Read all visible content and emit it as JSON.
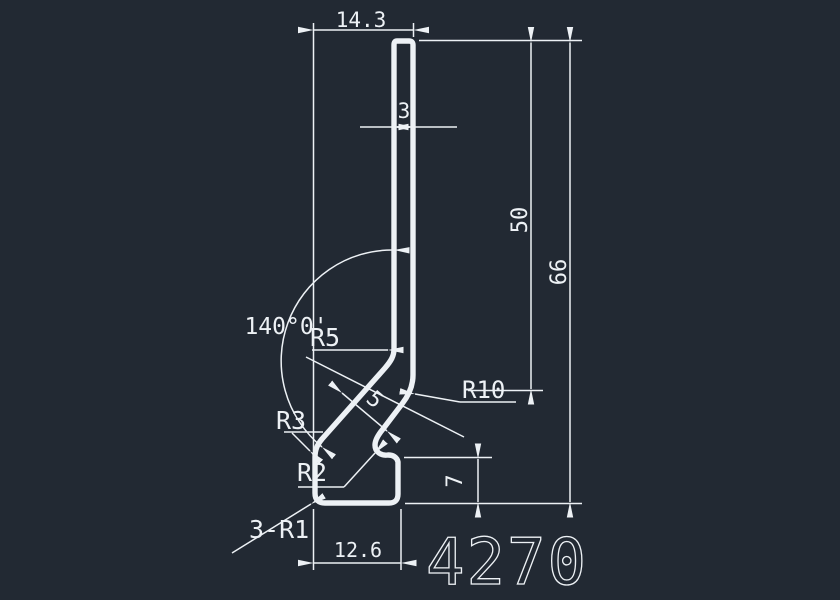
{
  "drawing": {
    "title": "profile-cross-section",
    "part_number": "4270",
    "colors": {
      "background": "#222933",
      "line": "#edf1f5"
    },
    "labels": {
      "top_width": "14.3",
      "wall_thickness_top": "3",
      "blade_height": "50",
      "total_height": "66",
      "bend_angle": "140°0'",
      "radius_r5": "R5",
      "radius_r10": "R10",
      "diagonal_thickness": "5",
      "radius_r3": "R3",
      "radius_r2": "R2",
      "corner_radii": "3-R1",
      "foot_height": "7",
      "foot_width": "12.6"
    }
  }
}
